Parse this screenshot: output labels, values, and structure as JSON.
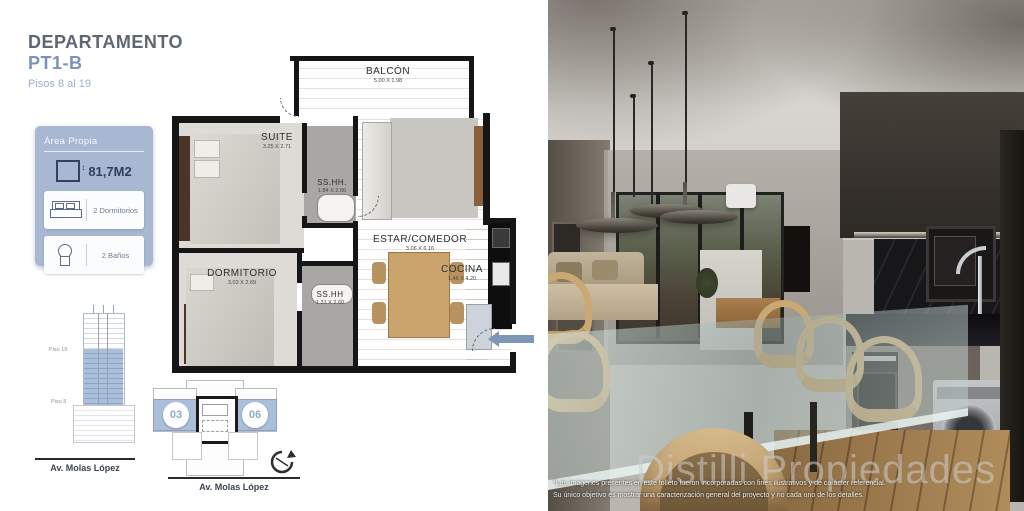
{
  "header": {
    "title_line1": "DEPARTAMENTO",
    "title_line2": "PT1-B",
    "subtitle": "Pisos 8 al 19"
  },
  "info_box": {
    "header": "Área Propia",
    "area_value": "81,7M2",
    "rows": [
      {
        "label": "2 Dormitorios"
      },
      {
        "label": "2 Baños"
      }
    ]
  },
  "floorplan": {
    "rooms": [
      {
        "name": "BALCÓN",
        "dims": "5.00 X 1.98"
      },
      {
        "name": "SUITE",
        "dims": "3.25 X 2.71"
      },
      {
        "name": "SS.HH.",
        "dims": "1.84 X 2.86"
      },
      {
        "name": "ESTAR/COMEDOR",
        "dims": "3.06 X 6.16"
      },
      {
        "name": "COCINA",
        "dims": "1.46 X 4.20"
      },
      {
        "name": "DORMITORIO",
        "dims": "3.03 X 2.69"
      },
      {
        "name": "SS.HH",
        "dims": "1.31 X 2.60"
      }
    ]
  },
  "elevation": {
    "top_floor_label": "Piso 19",
    "bottom_floor_label": "Piso 8",
    "street_label": "Av. Molas López"
  },
  "site_plan": {
    "unit_left": "03",
    "unit_right": "06",
    "street_label": "Av. Molas López"
  },
  "photo": {
    "disclaimer_line1": "*Las imágenes presentes en este folleto fueron incorporadas con fines ilustrativos y de carácter referencial.",
    "disclaimer_line2": "Su único objetivo es mostrar una caracterización general del proyecto y no cada uno de los detalles.",
    "watermark": "Distilli Propiedades"
  },
  "colors": {
    "accent_blue": "#7b93b8",
    "panel_blue": "#a9b8d2",
    "highlight_blue": "#aabfd9",
    "title_gray": "#5d6673",
    "wall_black": "#161616",
    "wood_floor": "#ddbb94"
  }
}
